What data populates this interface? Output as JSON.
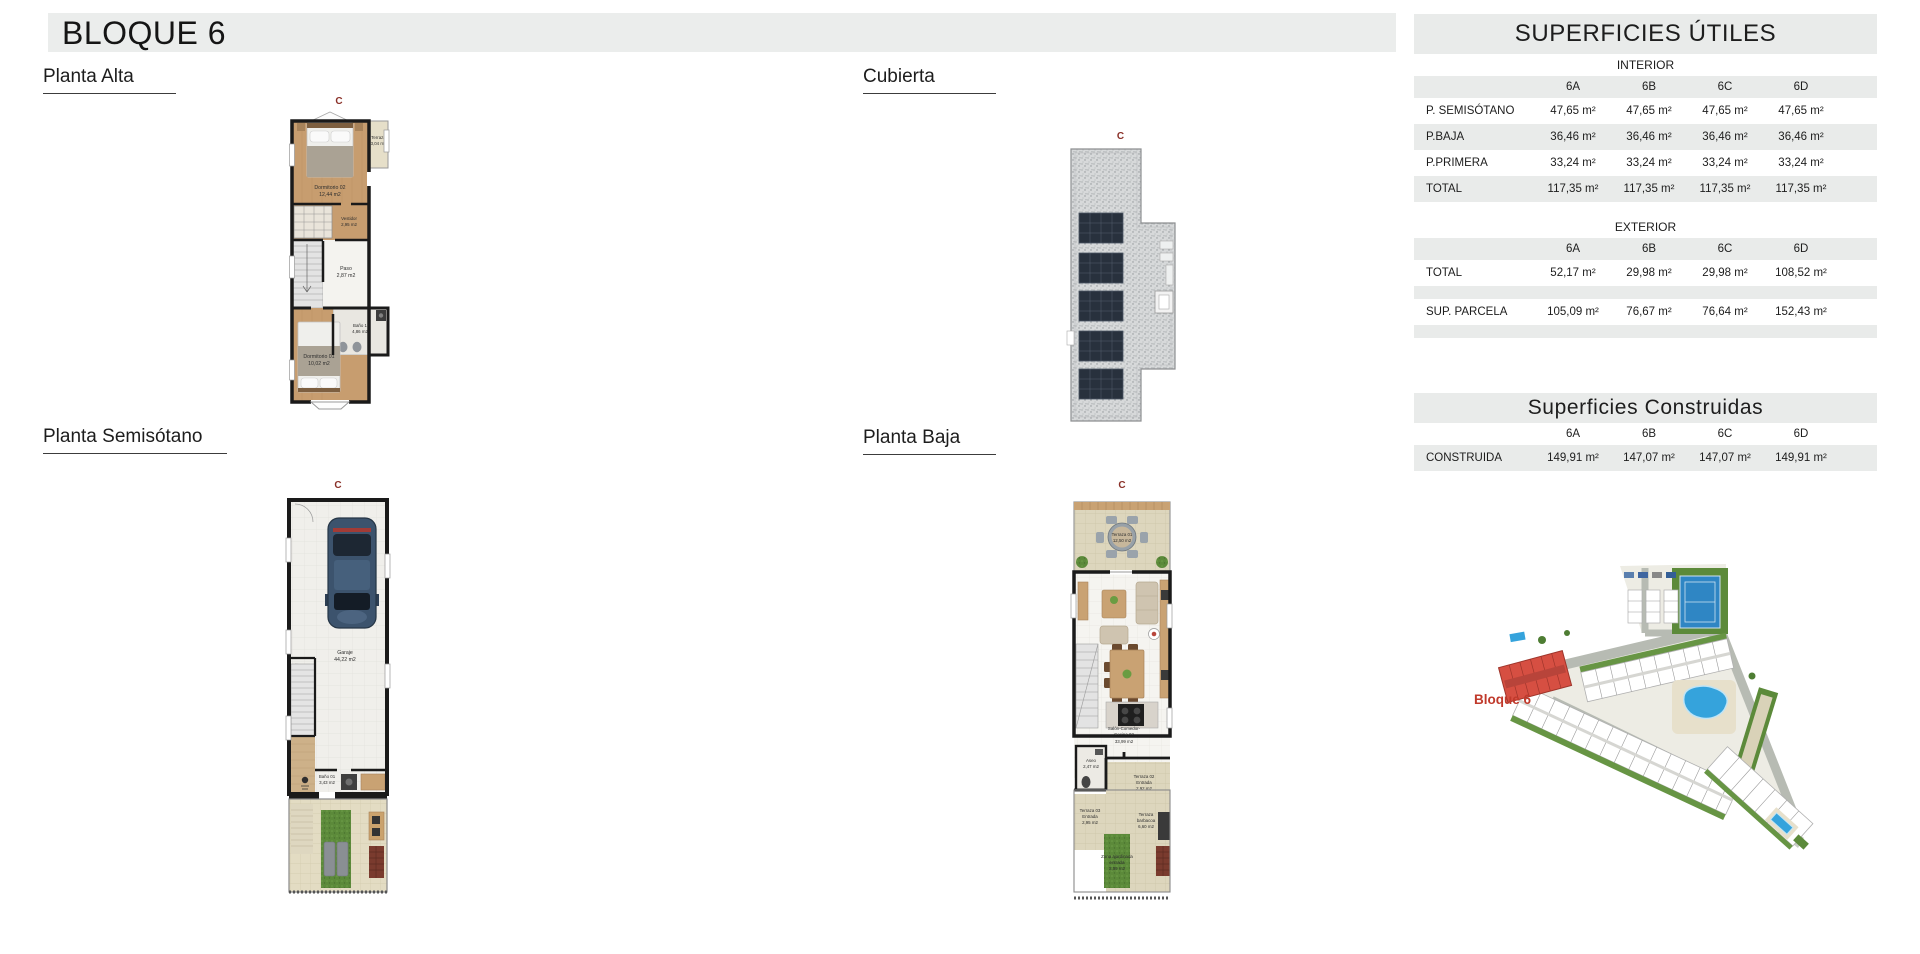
{
  "page": {
    "title": "BLOQUE 6"
  },
  "section_labels": {
    "planta_alta": "Planta Alta",
    "cubierta": "Cubierta",
    "planta_semisotano": "Planta Semisótano",
    "planta_baja": "Planta Baja"
  },
  "plan_marker": "C",
  "plans": {
    "alta": {
      "dormitorio02": {
        "name": "Dormitorio 02",
        "area": "12,44 m2"
      },
      "terraza": {
        "name": "Terraza",
        "area": "3,04 m2"
      },
      "vestidor": {
        "name": "Vestidor",
        "area": "2,95 m2"
      },
      "paso": {
        "name": "Paso",
        "area": "2,87 m2"
      },
      "bano1": {
        "name": "Baño 1",
        "area": "4,86 m2"
      },
      "dormitorio01": {
        "name": "Dormitorio 01",
        "area": "10,02 m2"
      }
    },
    "semisotano": {
      "garaje": {
        "name": "Garaje",
        "area": "44,22 m2"
      },
      "bano01": {
        "name": "Baño 01",
        "area": "3,43 m2"
      }
    },
    "baja": {
      "terraza01": {
        "name": "Terraza 01",
        "area": "12,50 m2"
      },
      "salon": {
        "line1": "Salón-Comedor-",
        "line2": "Cocina 02",
        "area": "33,99 m2"
      },
      "aseo": {
        "name": "Aseo",
        "area": "2,47 m2"
      },
      "terraza02": {
        "line1": "Terraza 02",
        "line2": "Entrada",
        "area": "2,92 m2"
      },
      "terraza03": {
        "line1": "Terraza 03",
        "line2": "Entrada",
        "area": "2,95 m2"
      },
      "barbacoa": {
        "line1": "Terraza",
        "line2": "barbacoa",
        "area": "6,60 m2"
      },
      "zona_ajardinada": {
        "line1": "Zona ajardinada",
        "line2": "entrada",
        "area": "2,59 m2"
      }
    }
  },
  "tables": {
    "utiles": {
      "title": "SUPERFICIES ÚTILES",
      "interior": {
        "label": "INTERIOR",
        "columns": [
          "6A",
          "6B",
          "6C",
          "6D"
        ],
        "rows": [
          {
            "label": "P. SEMISÓTANO",
            "values": [
              "47,65 m²",
              "47,65 m²",
              "47,65 m²",
              "47,65 m²"
            ]
          },
          {
            "label": "P.BAJA",
            "values": [
              "36,46 m²",
              "36,46 m²",
              "36,46 m²",
              "36,46 m²"
            ]
          },
          {
            "label": "P.PRIMERA",
            "values": [
              "33,24 m²",
              "33,24 m²",
              "33,24 m²",
              "33,24 m²"
            ]
          },
          {
            "label": "TOTAL",
            "values": [
              "117,35 m²",
              "117,35 m²",
              "117,35 m²",
              "117,35 m²"
            ]
          }
        ]
      },
      "exterior": {
        "label": "EXTERIOR",
        "columns": [
          "6A",
          "6B",
          "6C",
          "6D"
        ],
        "rows": [
          {
            "label": "TOTAL",
            "values": [
              "52,17 m²",
              "29,98 m²",
              "29,98 m²",
              "108,52 m²"
            ]
          },
          {
            "label": "SUP. PARCELA",
            "values": [
              "105,09 m²",
              "76,67 m²",
              "76,64 m²",
              "152,43 m²"
            ]
          }
        ]
      }
    },
    "construidas": {
      "title": "Superficies Construidas",
      "columns": [
        "6A",
        "6B",
        "6C",
        "6D"
      ],
      "rows": [
        {
          "label": "CONSTRUIDA",
          "values": [
            "149,91 m²",
            "147,07 m²",
            "147,07 m²",
            "149,91 m²"
          ]
        }
      ]
    }
  },
  "siteplan": {
    "label": "Bloque 6"
  },
  "colors": {
    "accent_red": "#c0392b",
    "marker_red": "#8a3028",
    "band_gray": "#ebedec",
    "table_gray": "#e9ebea",
    "pool_blue": "#35a3dc",
    "grass_green": "#5c8a3a"
  }
}
